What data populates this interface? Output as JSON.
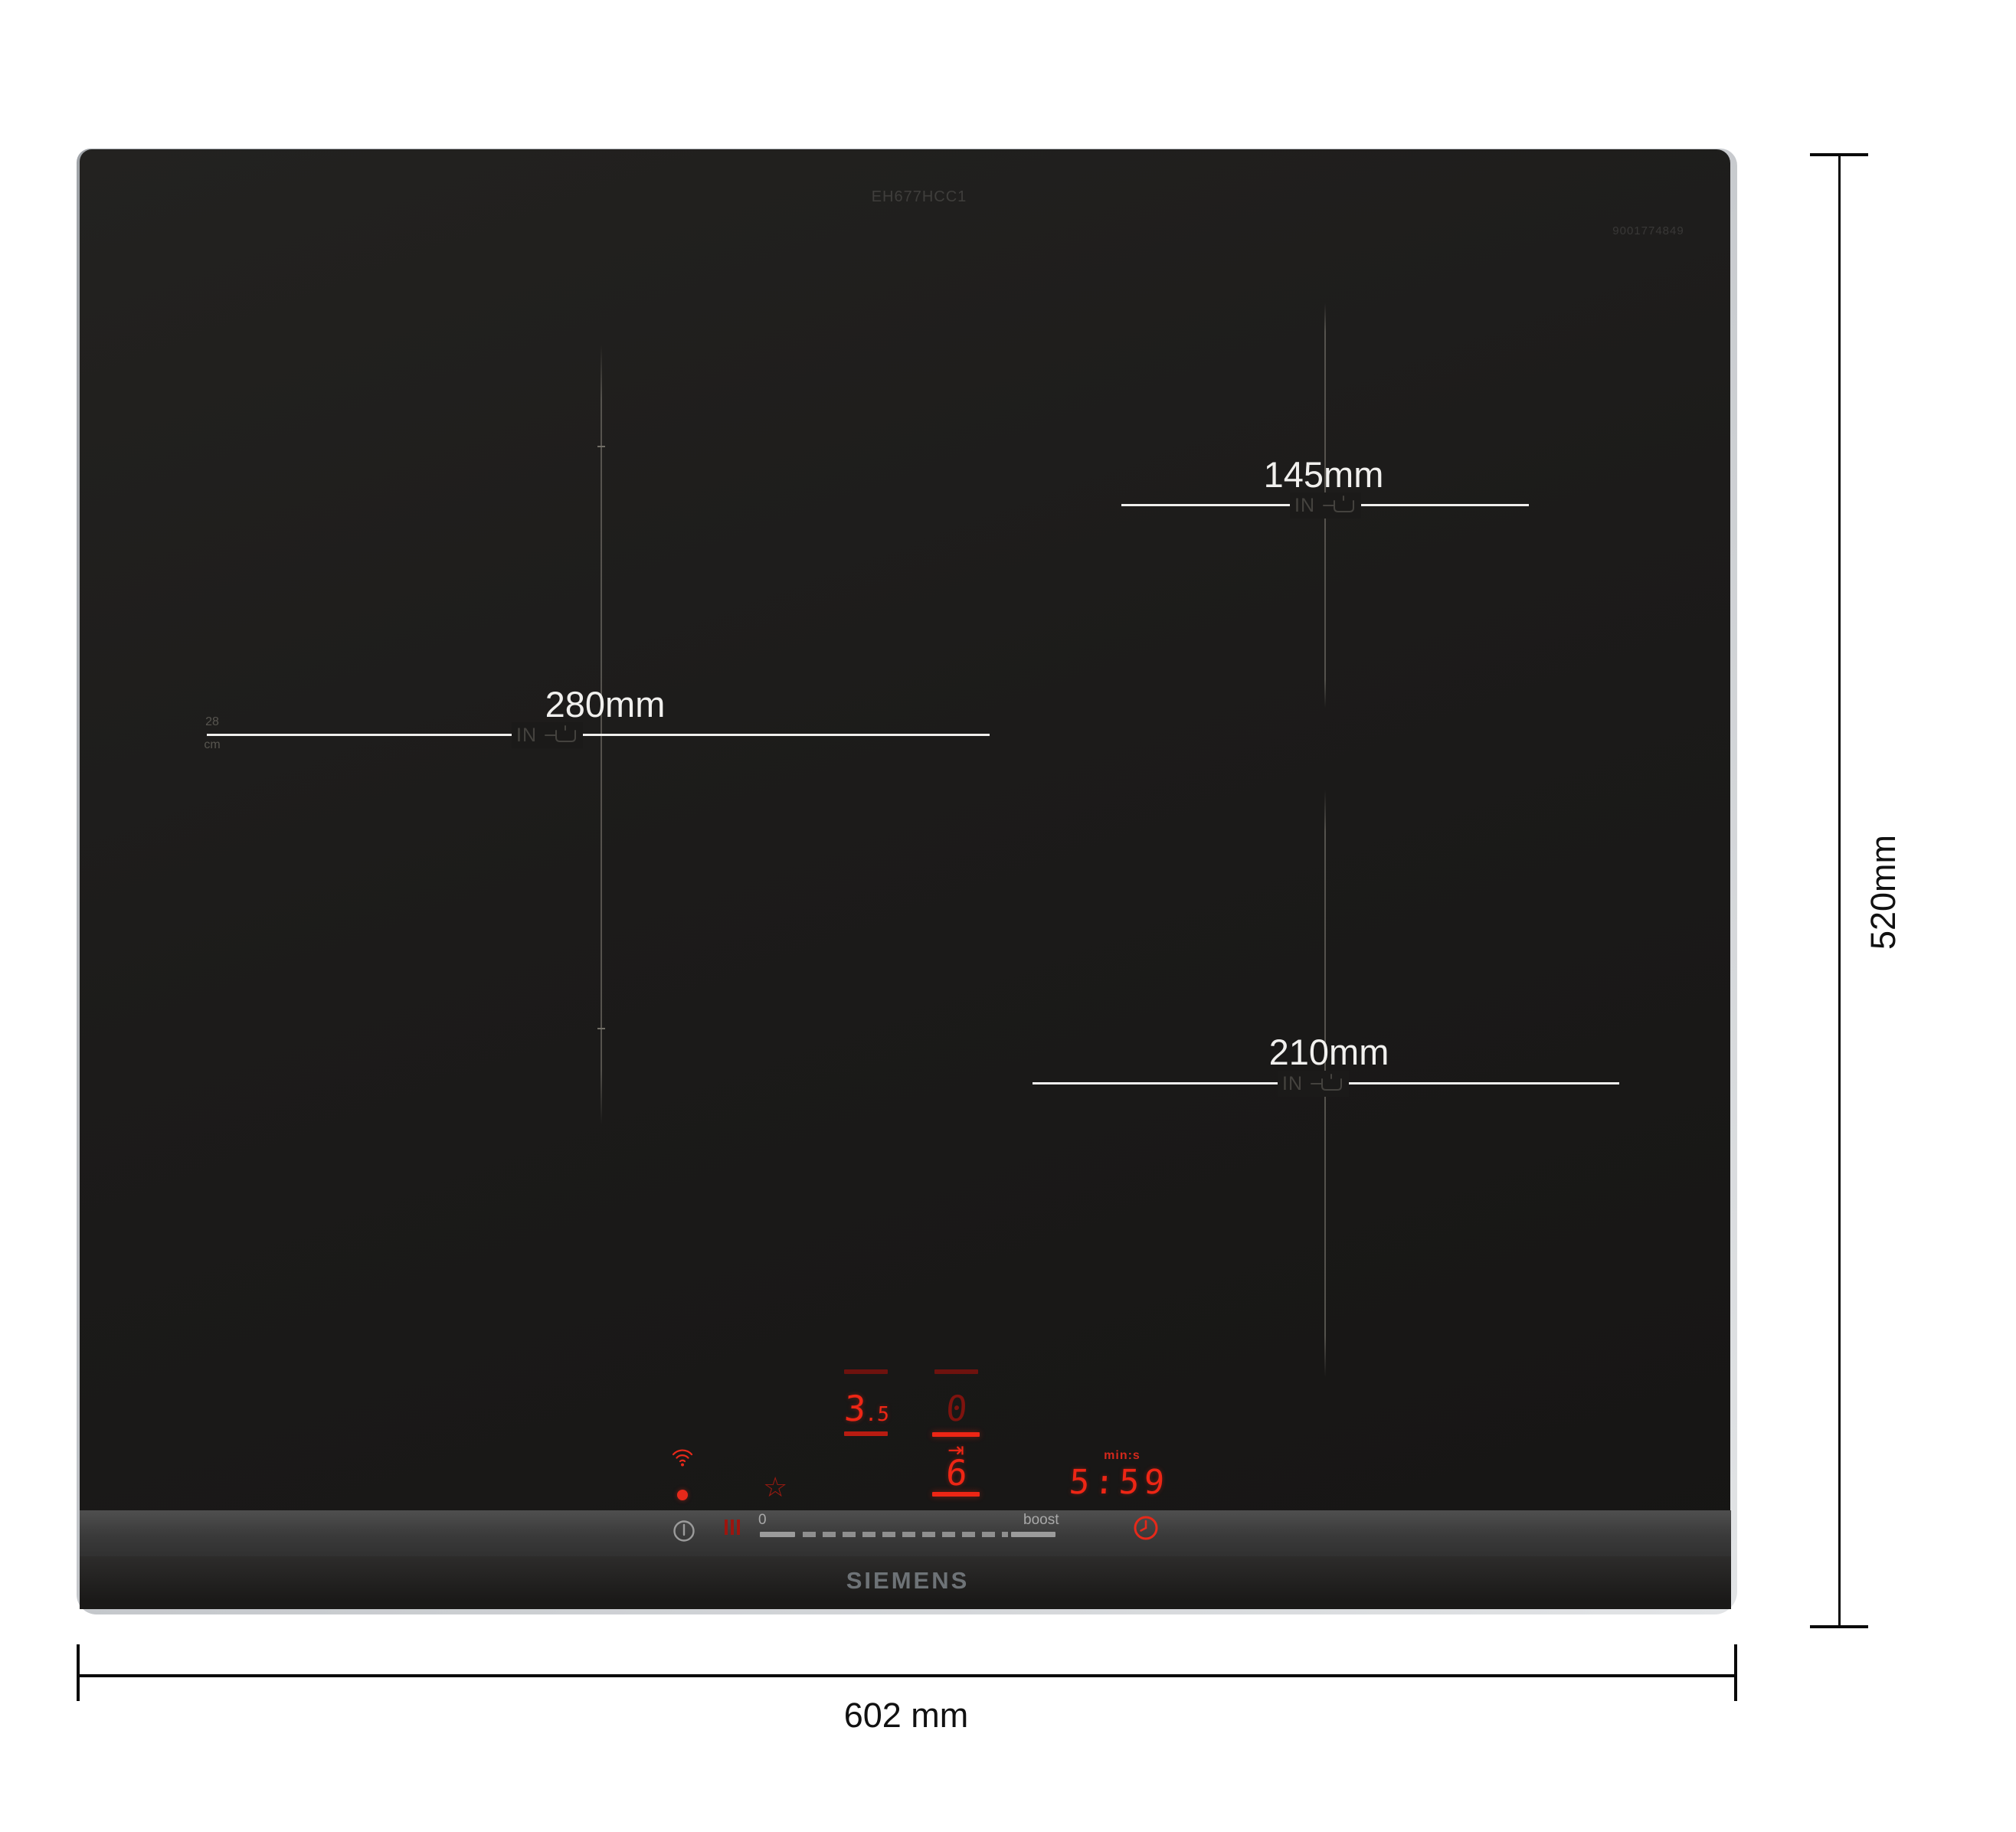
{
  "product": {
    "model": "EH677HCC1",
    "code": "9001774849",
    "brand": "SIEMENS"
  },
  "zones": {
    "left": {
      "label": "280mm",
      "pan_min": "28",
      "pan_unit": "cm",
      "in": "IN"
    },
    "top_right": {
      "label": "145mm",
      "in": "IN"
    },
    "bottom_right": {
      "label": "210mm",
      "in": "IN"
    }
  },
  "display": {
    "zone_left_level_int": "3",
    "zone_left_level_frac": ".5",
    "zone_center_top": "0",
    "zone_center_level": "6",
    "timer_unit": "min:s",
    "timer_value": "5:59"
  },
  "controls": {
    "slider_min": "0",
    "slider_boost": "boost"
  },
  "dimensions": {
    "width": "602 mm",
    "height": "520mm"
  },
  "icons": {
    "star": "☆",
    "move_to_bar": "⇥"
  },
  "colors": {
    "accent_red": "#ee2615",
    "dim_red": "#6e120e",
    "glass": "#1b1a19",
    "label_white": "#f1f0ee",
    "annotation": "#111111"
  }
}
